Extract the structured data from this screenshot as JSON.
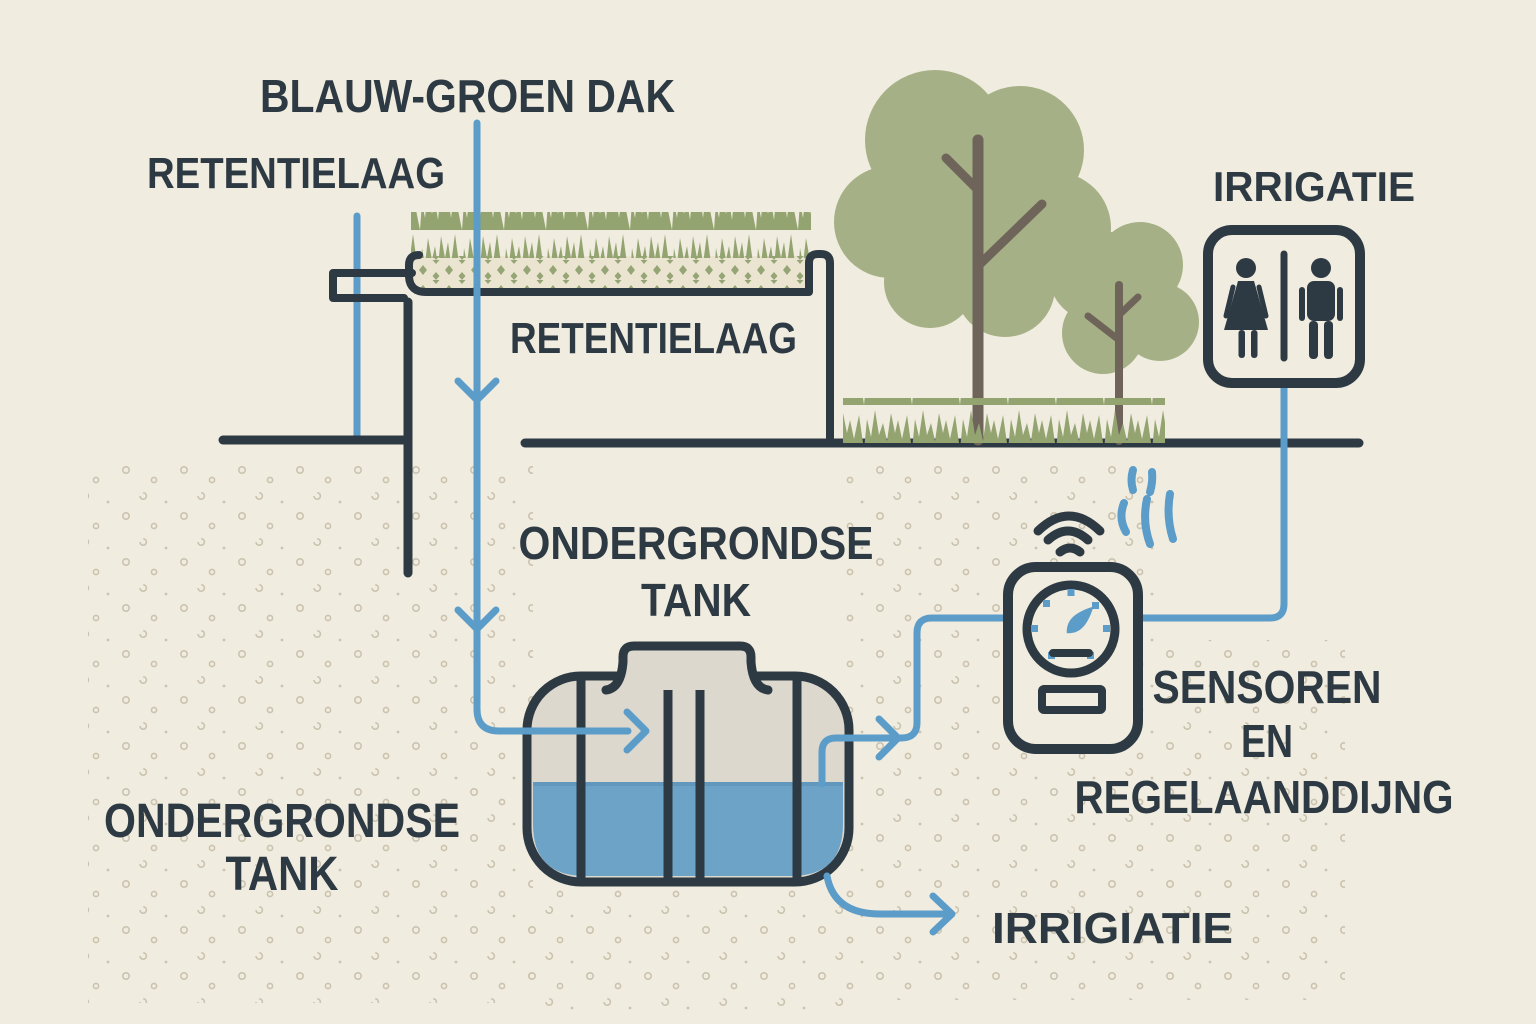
{
  "page": {
    "title": "BLAUW-GROEN DAK"
  },
  "labels": {
    "roof_title": "BLAUW-GROEN DAK",
    "retention_left": "RETENTIELAAG",
    "retention_roof": "RETENTIELAAG",
    "irrigation_top": "IRRIGATIE",
    "tank_label_top_line1": "ONDERGRONDSE",
    "tank_label_top_line2": "TANK",
    "tank_label_bottom_line1": "ONDERGRONDSE",
    "tank_label_bottom_line2": "TANK",
    "sensors_line1": "SENSOREN",
    "sensors_line2": "EN",
    "sensors_line3": "REGELAANDDIJNG",
    "irrigation_bottom": "IRRIGIATIE"
  },
  "icons": {
    "restroom_sign": "restroom-sign-icon",
    "wifi": "wifi-icon",
    "gauge": "gauge-icon",
    "signal_waves": "signal-waves-icon",
    "big_tree": "tree-icon",
    "small_tree": "tree-icon",
    "tank": "underground-tank-icon",
    "flow_arrows": "flow-arrow-icon"
  },
  "colors": {
    "background": "#f0ecdf",
    "outline": "#2e3a43",
    "pipe_blue": "#5b9cc9",
    "water_blue": "#6da3c7",
    "grass_green": "#93a470",
    "canopy_green": "#a5b086",
    "trunk_brown": "#6e6459",
    "substrate": "#ebe4d1",
    "substrate_diamond": "#96a575",
    "tank_interior": "#dcd8ce",
    "soil_dot": "#c5bca6"
  }
}
